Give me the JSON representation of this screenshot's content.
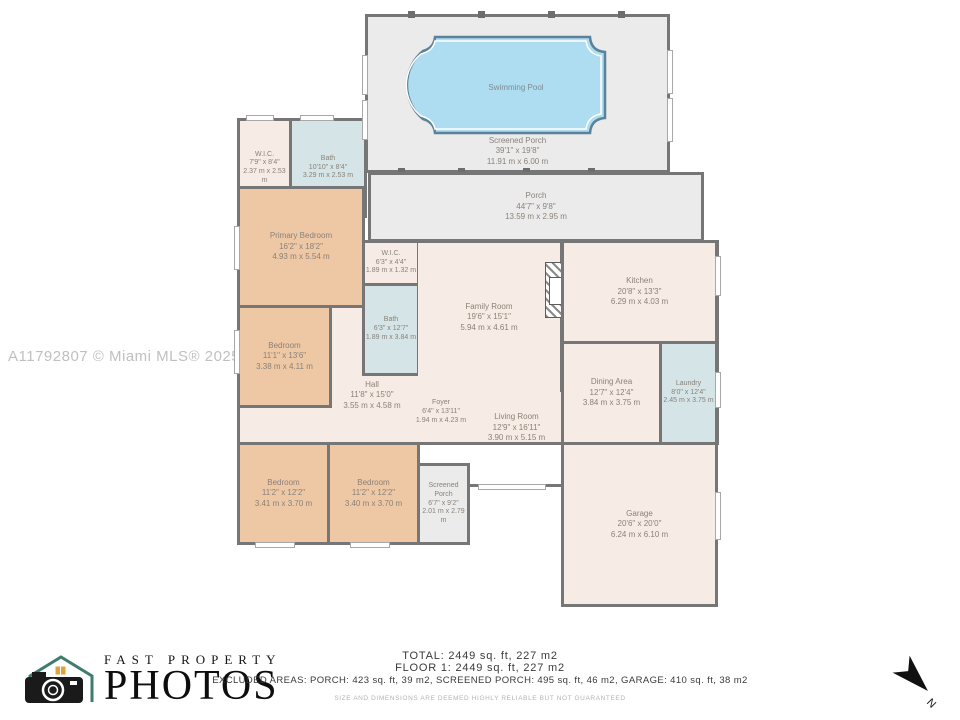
{
  "watermark": {
    "text": "A11792807 © Miami MLS® 2025"
  },
  "colors": {
    "wall": "#767676",
    "porch_fill": "#ebebeb",
    "room_fill": "#f6ece5",
    "bedroom_fill": "#eec7a5",
    "wet_room_fill": "#d5e4e6",
    "pool_fill": "#aedcf0",
    "pool_outline": "#5b8299",
    "label_text": "#8a8279",
    "logo_teal": "#3e7d6d",
    "logo_orange": "#e0a23b"
  },
  "rooms": {
    "pool": {
      "name": "Swimming Pool"
    },
    "screened_porch_pool": {
      "name": "Screened Porch",
      "ft": "39'1\" x 19'8\"",
      "m": "11.91 m x 6.00 m"
    },
    "porch": {
      "name": "Porch",
      "ft": "44'7\" x 9'8\"",
      "m": "13.59 m x 2.95 m"
    },
    "wic_primary": {
      "name": "W.I.C.",
      "ft": "7'9\" x 8'4\"",
      "m": "2.37 m x 2.53 m"
    },
    "bath_primary": {
      "name": "Bath",
      "ft": "10'10\" x 8'4\"",
      "m": "3.29 m x 2.53 m"
    },
    "primary_bedroom": {
      "name": "Primary Bedroom",
      "ft": "16'2\" x 18'2\"",
      "m": "4.93 m x 5.54 m"
    },
    "wic_hall": {
      "name": "W.I.C.",
      "ft": "6'3\" x 4'4\"",
      "m": "1.89 m x 1.32 m"
    },
    "bath_hall": {
      "name": "Bath",
      "ft": "6'3\" x 12'7\"",
      "m": "1.89 m x 3.84 m"
    },
    "family_room": {
      "name": "Family Room",
      "ft": "19'6\" x 15'1\"",
      "m": "5.94 m x 4.61 m"
    },
    "kitchen": {
      "name": "Kitchen",
      "ft": "20'8\" x 13'3\"",
      "m": "6.29 m x 4.03 m"
    },
    "bedroom_mid": {
      "name": "Bedroom",
      "ft": "11'1\" x 13'6\"",
      "m": "3.38 m x 4.11 m"
    },
    "hall": {
      "name": "Hall",
      "ft": "11'8\" x 15'0\"",
      "m": "3.55 m x 4.58 m"
    },
    "dining_area": {
      "name": "Dining Area",
      "ft": "12'7\" x 12'4\"",
      "m": "3.84 m x 3.75 m"
    },
    "laundry": {
      "name": "Laundry",
      "ft": "8'0\" x 12'4\"",
      "m": "2.45 m x 3.75 m"
    },
    "foyer": {
      "name": "Foyer",
      "ft": "6'4\" x 13'11\"",
      "m": "1.94 m x 4.23 m"
    },
    "living_room": {
      "name": "Living Room",
      "ft": "12'9\" x 16'11\"",
      "m": "3.90 m x 5.15 m"
    },
    "bedroom_b1": {
      "name": "Bedroom",
      "ft": "11'2\" x 12'2\"",
      "m": "3.41 m x 3.70 m"
    },
    "bedroom_b2": {
      "name": "Bedroom",
      "ft": "11'2\" x 12'2\"",
      "m": "3.40 m x 3.70 m"
    },
    "screened_porch_rear": {
      "name": "Screened Porch",
      "ft": "6'7\" x 9'2\"",
      "m": "2.01 m x 2.79 m"
    },
    "garage": {
      "name": "Garage",
      "ft": "20'6\" x 20'0\"",
      "m": "6.24 m x 6.10 m"
    }
  },
  "footer": {
    "logo_line1": "FAST PROPERTY",
    "logo_line2": "PHOTOS",
    "total": "TOTAL: 2449 sq. ft, 227 m2",
    "floor1": "FLOOR 1: 2449 sq. ft, 227 m2",
    "excluded": "EXCLUDED AREAS: PORCH: 423 sq. ft, 39 m2, SCREENED PORCH: 495 sq. ft, 46 m2, GARAGE: 410 sq. ft, 38 m2",
    "disclaimer": "SIZE AND DIMENSIONS ARE DEEMED HIGHLY RELIABLE BUT NOT GUARANTEED",
    "north_label": "N"
  }
}
